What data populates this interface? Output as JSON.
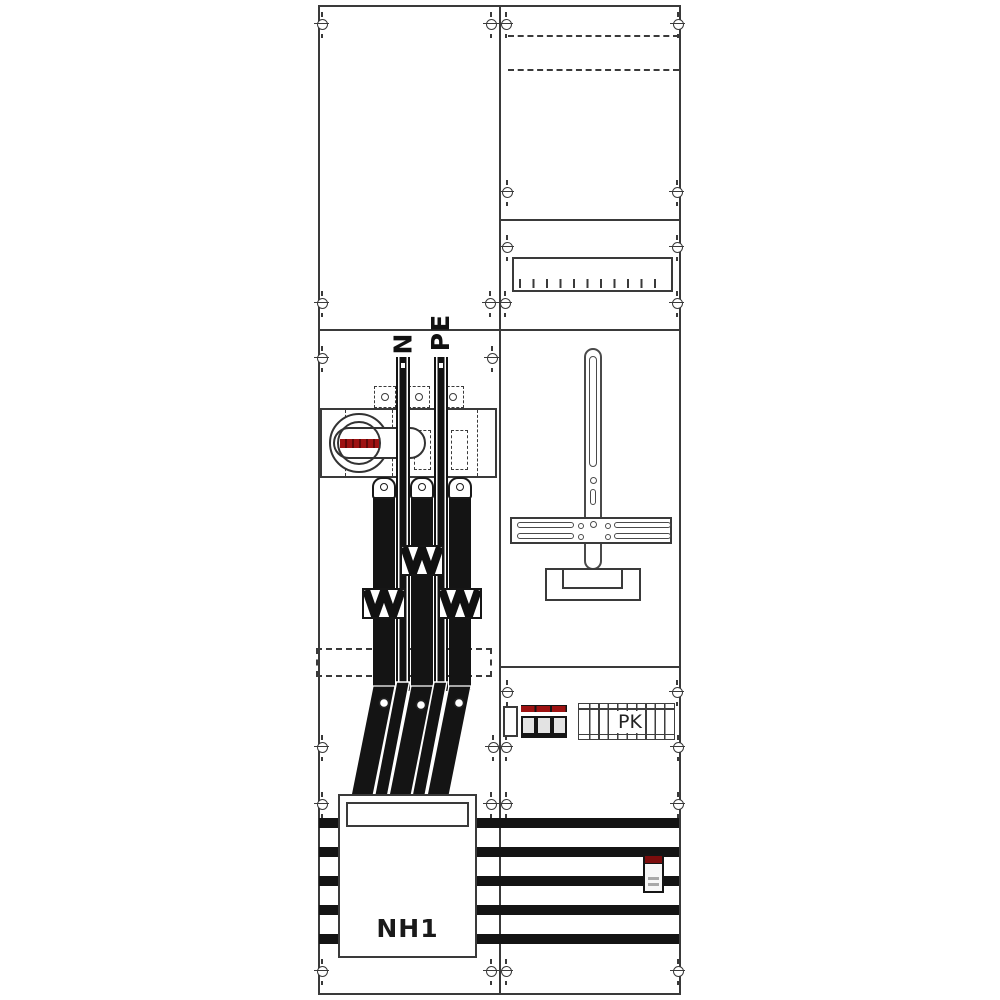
{
  "diagram": {
    "kind": "meter-cabinet-wiring-diagram",
    "labels": {
      "neutral_bar": "N",
      "pe_bar": "PE",
      "nh_fuse_box": "NH1",
      "comb_busbar": "PK"
    },
    "colors": {
      "line": "#3a3a3a",
      "conductor": "#131313",
      "handle_red": "#9e1212",
      "breaker_cap_red": "#7c0d0d",
      "background": "#ffffff"
    }
  }
}
